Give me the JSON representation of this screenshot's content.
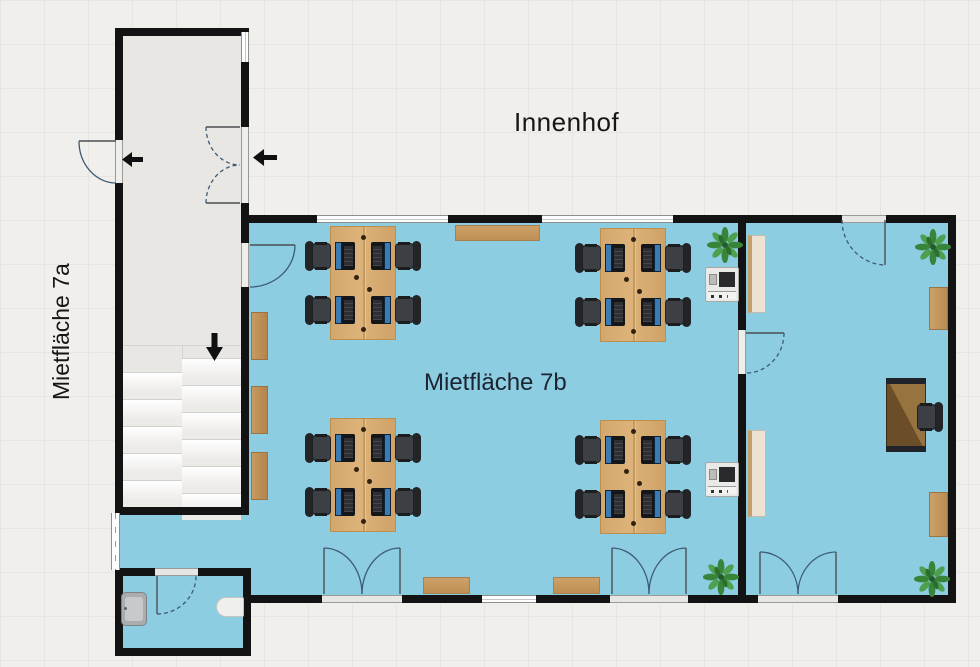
{
  "rooms": [
    {
      "id": "courtyard",
      "label": "Innenhof"
    },
    {
      "id": "unit-7a",
      "label": "Mietfläche 7a"
    },
    {
      "id": "unit-7b",
      "label": "Mietfläche 7b"
    }
  ],
  "colors": {
    "floor_blue": "#8ccde2",
    "wall_black": "#131313",
    "stairwell_gray": "#e9e7e3",
    "wood": "#d8ad74",
    "plant_green": "#38853a"
  },
  "symbols": {
    "entrance_arrows": [
      {
        "name": "entrance-arrow-left-outer",
        "direction": "left",
        "x": 122,
        "y": 151
      },
      {
        "name": "entrance-arrow-left-inner",
        "direction": "left",
        "x": 253,
        "y": 148
      },
      {
        "name": "stairs-arrow-down",
        "direction": "down",
        "x": 206,
        "y": 333
      }
    ]
  },
  "stairs": {
    "x": 123,
    "width": 118,
    "top": 345,
    "bottom": 507,
    "step_height": 27,
    "left_col": {
      "x": 123,
      "w": 59,
      "start": 372,
      "count": 5
    },
    "right_col": {
      "x": 182,
      "w": 59,
      "start": 358,
      "count": 6
    }
  },
  "furniture": {
    "desk_clusters": [
      {
        "x": 330,
        "y": 226
      },
      {
        "x": 600,
        "y": 228
      },
      {
        "x": 330,
        "y": 418
      },
      {
        "x": 600,
        "y": 420
      }
    ],
    "plants": [
      {
        "x": 706,
        "y": 226
      },
      {
        "x": 702,
        "y": 558
      },
      {
        "x": 914,
        "y": 228
      },
      {
        "x": 913,
        "y": 560
      }
    ],
    "printers": [
      {
        "x": 705,
        "y": 267
      },
      {
        "x": 705,
        "y": 462
      }
    ],
    "wall_strips": [
      {
        "x": 251,
        "y": 312
      },
      {
        "x": 251,
        "y": 386
      },
      {
        "x": 251,
        "y": 452
      }
    ],
    "sideboards": [
      {
        "x": 455,
        "y": 225,
        "w": 85,
        "h": 16
      },
      {
        "x": 423,
        "y": 577,
        "w": 47,
        "h": 17
      },
      {
        "x": 553,
        "y": 577,
        "w": 47,
        "h": 17
      }
    ],
    "radiators": [
      {
        "x": 748,
        "y": 235,
        "w": 18,
        "h": 78
      },
      {
        "x": 748,
        "y": 430,
        "w": 18,
        "h": 87
      }
    ],
    "shelves": [
      {
        "x": 929,
        "y": 287,
        "w": 19,
        "h": 43
      },
      {
        "x": 929,
        "y": 492,
        "w": 19,
        "h": 45
      }
    ],
    "desk": {
      "x": 886,
      "y": 378,
      "w": 40,
      "h": 74
    },
    "desk_chair": {
      "x": 916,
      "y": 401
    },
    "sink": {
      "x": 121,
      "y": 592,
      "w": 26,
      "h": 34
    },
    "toilet": {
      "x": 216,
      "y": 597,
      "w": 28,
      "h": 20
    }
  }
}
